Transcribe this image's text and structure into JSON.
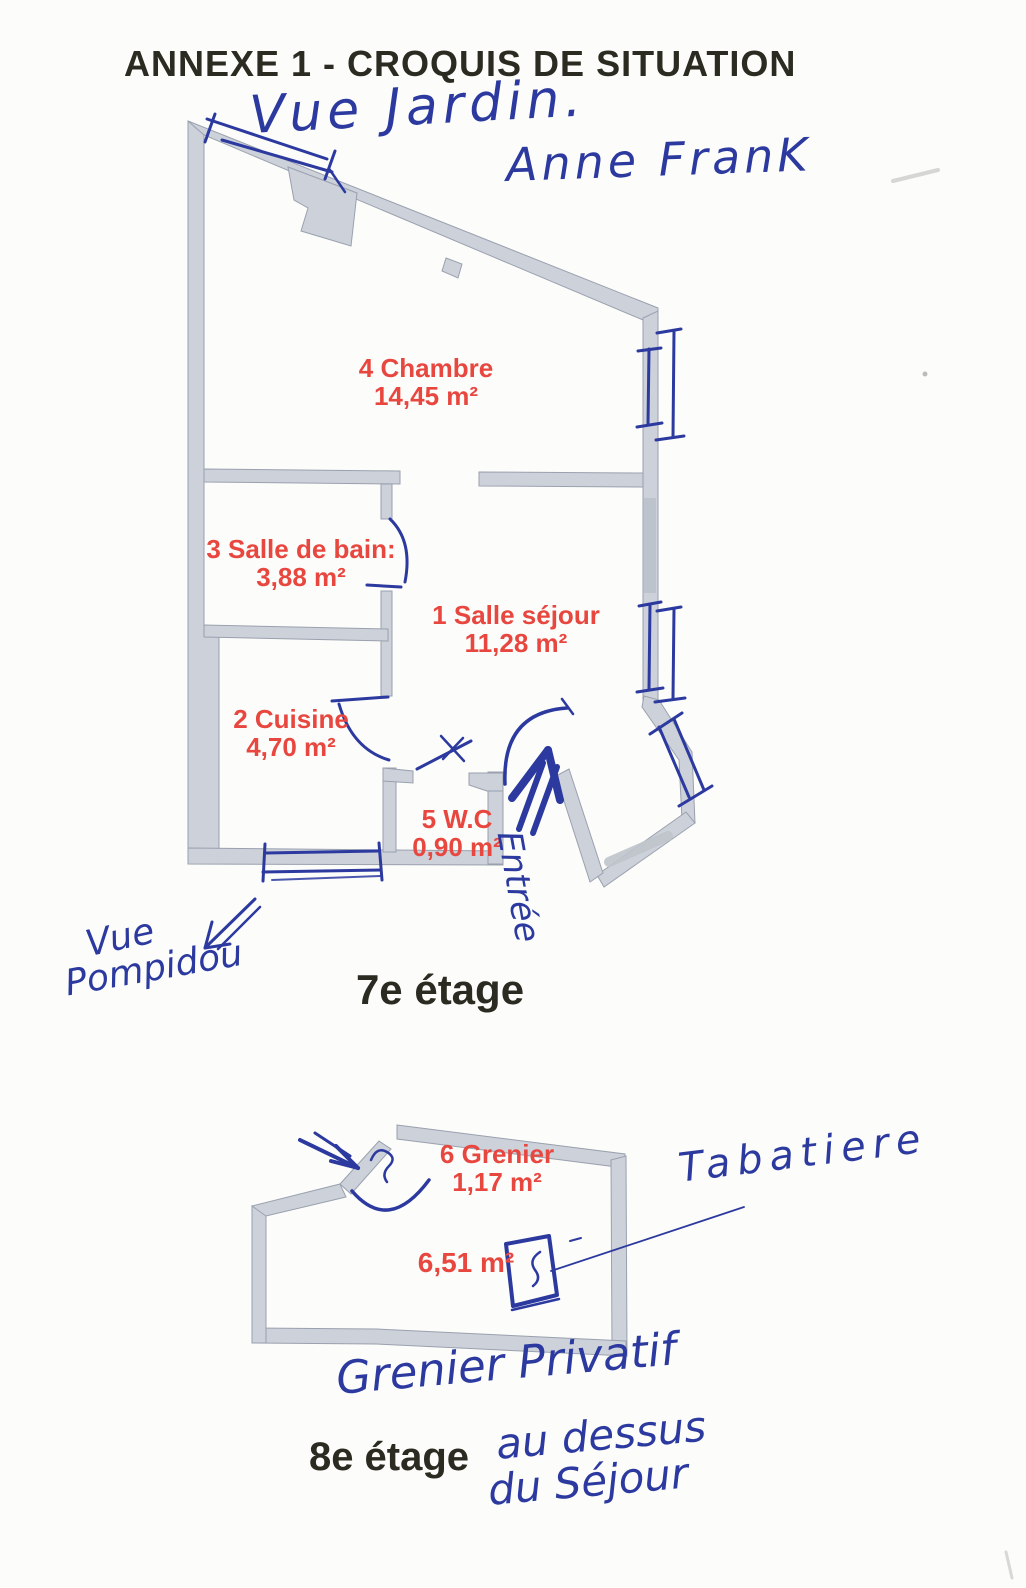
{
  "page": {
    "title": "ANNEXE 1 - CROQUIS DE SITUATION"
  },
  "floor7": {
    "label": "7e étage",
    "rooms": {
      "chambre": {
        "name": "4 Chambre",
        "area": "14,45 m²"
      },
      "salle_de_bain": {
        "name": "3 Salle de bain:",
        "area": "3,88 m²"
      },
      "salle_sejour": {
        "name": "1 Salle séjour",
        "area": "11,28 m²"
      },
      "cuisine": {
        "name": "2 Cuisine",
        "area": "4,70 m²"
      },
      "wc": {
        "name": "5 W.C",
        "area": "0,90 m²"
      }
    },
    "handwriting": {
      "vue_jardin": "Vue Jardin.",
      "anne_frank": "Anne FranK",
      "entree": "Entrée",
      "vue": "Vue",
      "pompidou": "Pompidou"
    }
  },
  "floor8": {
    "label": "8e étage",
    "rooms": {
      "grenier": {
        "name": "6 Grenier",
        "area": "1,17 m²"
      },
      "main": {
        "area": "6,51 m²"
      }
    },
    "handwriting": {
      "tabatiere": "Tabatiere",
      "grenier_privatif": "Grenier Privatif",
      "au_dessus": "au dessus",
      "du_sejour": "du Séjour"
    }
  },
  "colors": {
    "ink": "#2c3aa0",
    "wall_fill": "#ccd1da",
    "wall_edge": "#9aa1ae",
    "room_label": "#e8473f",
    "print_text": "#2b2b22"
  }
}
